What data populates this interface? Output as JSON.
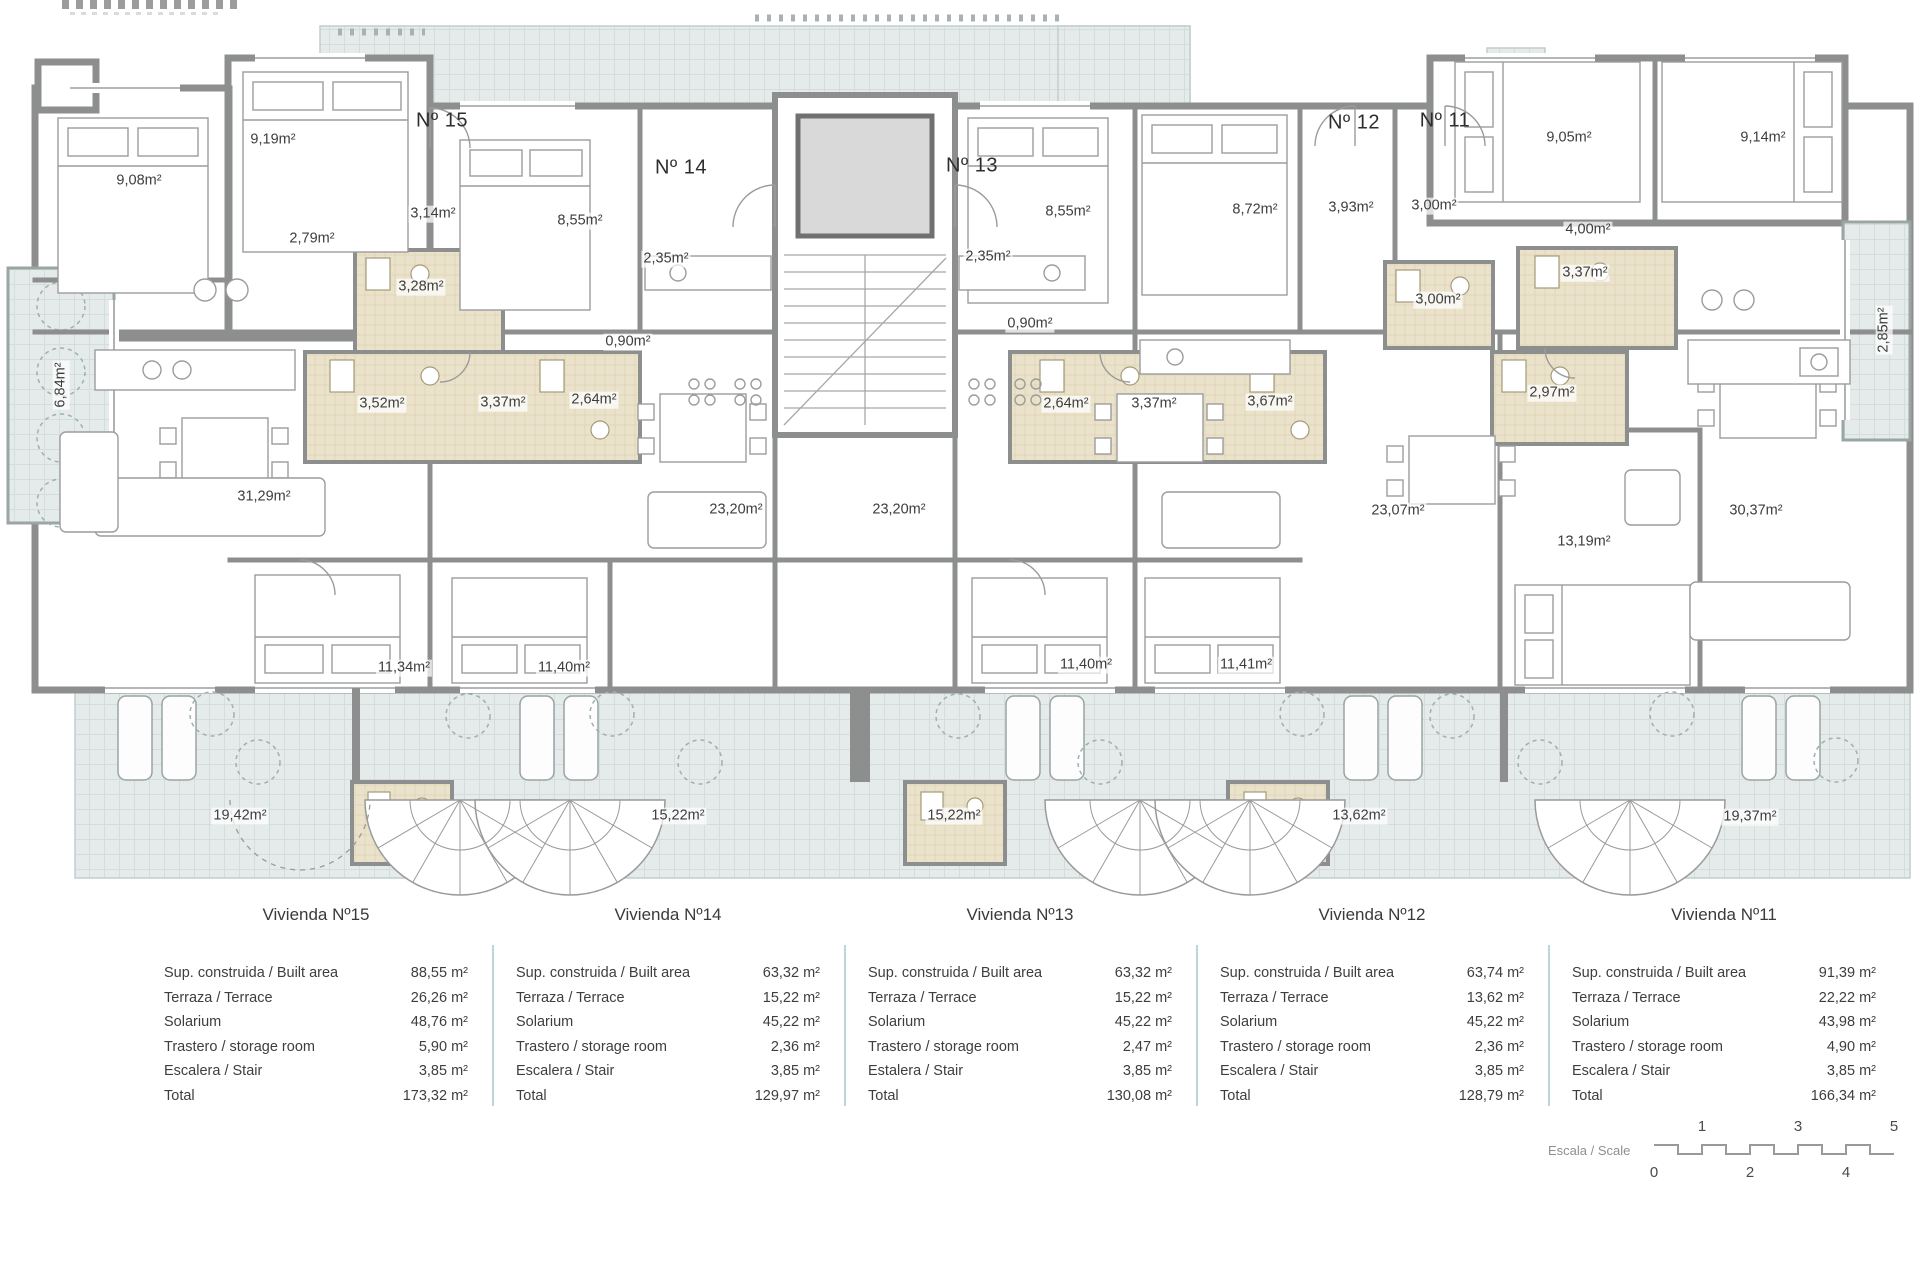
{
  "plan": {
    "apartment_labels": [
      {
        "text": "Nº 15",
        "x": 442,
        "y": 121
      },
      {
        "text": "Nº 14",
        "x": 681,
        "y": 168
      },
      {
        "text": "Nº 13",
        "x": 972,
        "y": 166
      },
      {
        "text": "Nº 12",
        "x": 1354,
        "y": 123
      },
      {
        "text": "Nº 11",
        "x": 1445,
        "y": 121
      }
    ],
    "room_labels": [
      {
        "text": "9,08m²",
        "x": 139,
        "y": 181
      },
      {
        "text": "9,19m²",
        "x": 273,
        "y": 140
      },
      {
        "text": "2,79m²",
        "x": 312,
        "y": 239
      },
      {
        "text": "3,14m²",
        "x": 433,
        "y": 214
      },
      {
        "text": "3,28m²",
        "x": 421,
        "y": 287
      },
      {
        "text": "8,55m²",
        "x": 580,
        "y": 221
      },
      {
        "text": "2,35m²",
        "x": 666,
        "y": 259
      },
      {
        "text": "0,90m²",
        "x": 628,
        "y": 342
      },
      {
        "text": "3,52m²",
        "x": 382,
        "y": 404
      },
      {
        "text": "3,37m²",
        "x": 503,
        "y": 403
      },
      {
        "text": "2,64m²",
        "x": 594,
        "y": 400
      },
      {
        "text": "31,29m²",
        "x": 264,
        "y": 497
      },
      {
        "text": "23,20m²",
        "x": 736,
        "y": 510
      },
      {
        "text": "11,34m²",
        "x": 404,
        "y": 668
      },
      {
        "text": "11,40m²",
        "x": 564,
        "y": 668
      },
      {
        "text": "2,35m²",
        "x": 988,
        "y": 257
      },
      {
        "text": "0,90m²",
        "x": 1030,
        "y": 324
      },
      {
        "text": "8,55m²",
        "x": 1068,
        "y": 212
      },
      {
        "text": "2,64m²",
        "x": 1066,
        "y": 404
      },
      {
        "text": "3,37m²",
        "x": 1154,
        "y": 404
      },
      {
        "text": "3,67m²",
        "x": 1270,
        "y": 402
      },
      {
        "text": "23,20m²",
        "x": 899,
        "y": 510
      },
      {
        "text": "11,40m²",
        "x": 1086,
        "y": 665
      },
      {
        "text": "11,41m²",
        "x": 1246,
        "y": 665
      },
      {
        "text": "8,72m²",
        "x": 1255,
        "y": 210
      },
      {
        "text": "3,93m²",
        "x": 1351,
        "y": 208
      },
      {
        "text": "3,00m²",
        "x": 1434,
        "y": 206
      },
      {
        "text": "9,05m²",
        "x": 1569,
        "y": 138
      },
      {
        "text": "9,14m²",
        "x": 1763,
        "y": 138
      },
      {
        "text": "4,00m²",
        "x": 1588,
        "y": 230
      },
      {
        "text": "3,37m²",
        "x": 1585,
        "y": 273
      },
      {
        "text": "3,00m²",
        "x": 1438,
        "y": 300
      },
      {
        "text": "2,97m²",
        "x": 1552,
        "y": 393
      },
      {
        "text": "23,07m²",
        "x": 1398,
        "y": 511
      },
      {
        "text": "13,19m²",
        "x": 1584,
        "y": 542
      },
      {
        "text": "30,37m²",
        "x": 1756,
        "y": 511
      },
      {
        "text": "19,42m²",
        "x": 240,
        "y": 816
      },
      {
        "text": "15,22m²",
        "x": 678,
        "y": 816
      },
      {
        "text": "15,22m²",
        "x": 954,
        "y": 816
      },
      {
        "text": "13,62m²",
        "x": 1359,
        "y": 816
      },
      {
        "text": "19,37m²",
        "x": 1750,
        "y": 817
      },
      {
        "text": "6,84m²",
        "x": 61,
        "y": 385,
        "rot": -90
      },
      {
        "text": "2,85m²",
        "x": 1884,
        "y": 330,
        "rot": -90
      }
    ]
  },
  "tables": {
    "columns": [
      {
        "title": "Vivienda Nº15",
        "rows": [
          {
            "label": "Sup. construida / Built area",
            "value": "88,55 m²"
          },
          {
            "label": "Terraza / Terrace",
            "value": "26,26 m²"
          },
          {
            "label": "Solarium",
            "value": "48,76 m²"
          },
          {
            "label": "Trastero / storage room",
            "value": "5,90 m²"
          },
          {
            "label": "Escalera / Stair",
            "value": "3,85 m²"
          },
          {
            "label": "Total",
            "value": "173,32 m²"
          }
        ]
      },
      {
        "title": "Vivienda Nº14",
        "rows": [
          {
            "label": "Sup. construida / Built area",
            "value": "63,32 m²"
          },
          {
            "label": "Terraza / Terrace",
            "value": "15,22 m²"
          },
          {
            "label": "Solarium",
            "value": "45,22 m²"
          },
          {
            "label": "Trastero / storage room",
            "value": "2,36 m²"
          },
          {
            "label": "Escalera / Stair",
            "value": "3,85 m²"
          },
          {
            "label": "Total",
            "value": "129,97 m²"
          }
        ]
      },
      {
        "title": "Vivienda Nº13",
        "rows": [
          {
            "label": "Sup. construida / Built area",
            "value": "63,32 m²"
          },
          {
            "label": "Terraza / Terrace",
            "value": "15,22 m²"
          },
          {
            "label": "Solarium",
            "value": "45,22 m²"
          },
          {
            "label": "Trastero / storage room",
            "value": "2,47 m²"
          },
          {
            "label": "Estalera / Stair",
            "value": "3,85 m²"
          },
          {
            "label": "Total",
            "value": "130,08 m²"
          }
        ]
      },
      {
        "title": "Vivienda Nº12",
        "rows": [
          {
            "label": "Sup. construida / Built area",
            "value": "63,74 m²"
          },
          {
            "label": "Terraza / Terrace",
            "value": "13,62 m²"
          },
          {
            "label": "Solarium",
            "value": "45,22 m²"
          },
          {
            "label": "Trastero / storage room",
            "value": "2,36 m²"
          },
          {
            "label": "Escalera / Stair",
            "value": "3,85 m²"
          },
          {
            "label": "Total",
            "value": "128,79 m²"
          }
        ]
      },
      {
        "title": "Vivienda Nº11",
        "rows": [
          {
            "label": "Sup. construida / Built area",
            "value": "91,39 m²"
          },
          {
            "label": "Terraza / Terrace",
            "value": "22,22 m²"
          },
          {
            "label": "Solarium",
            "value": "43,98 m²"
          },
          {
            "label": "Trastero / storage room",
            "value": "4,90 m²"
          },
          {
            "label": "Escalera / Stair",
            "value": "3,85 m²"
          },
          {
            "label": "Total",
            "value": "166,34 m²"
          }
        ]
      }
    ]
  },
  "scalebar": {
    "label": "Escala / Scale",
    "top": [
      "1",
      "3",
      "5"
    ],
    "bottom": [
      "0",
      "2",
      "4"
    ]
  }
}
